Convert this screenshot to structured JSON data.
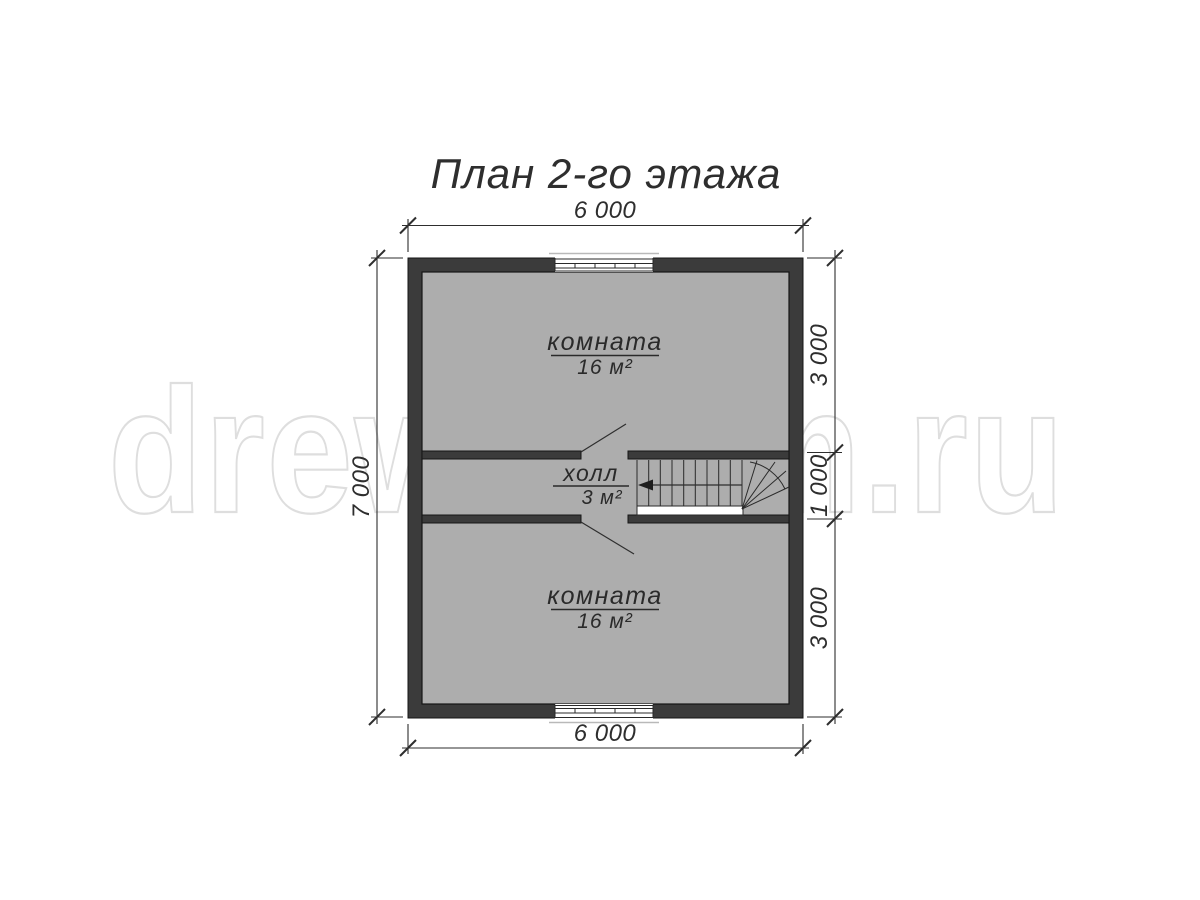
{
  "title": "План 2-го этажа",
  "watermark": "drew-dom.ru",
  "rooms": [
    {
      "name": "комната",
      "area": "16 м²"
    },
    {
      "name": "холл",
      "area": "3 м²"
    },
    {
      "name": "комната",
      "area": "16 м²"
    }
  ],
  "dimensions": {
    "top": "6 000",
    "bottom": "6 000",
    "left": "7 000",
    "right": [
      "3 000",
      "1 000",
      "3 000"
    ]
  },
  "colors": {
    "wall": "#3b3b3b",
    "wall_outline": "#161616",
    "room_fill": "#f3f3f3",
    "line": "#2e2e2e",
    "watermark_outline": "#dedede",
    "background": "#ffffff"
  }
}
